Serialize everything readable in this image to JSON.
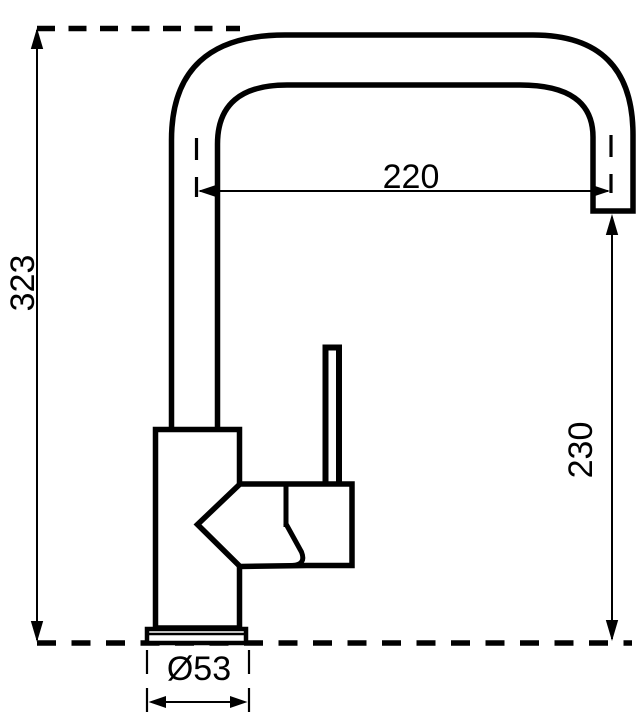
{
  "drawing": {
    "subject": "single-lever-kitchen-faucet-side-view",
    "background_color": "#ffffff",
    "line_color": "#000000",
    "dimensions": {
      "overall_height": "323",
      "spout_reach": "220",
      "outlet_height": "230",
      "base_diameter": "Ø53"
    }
  }
}
